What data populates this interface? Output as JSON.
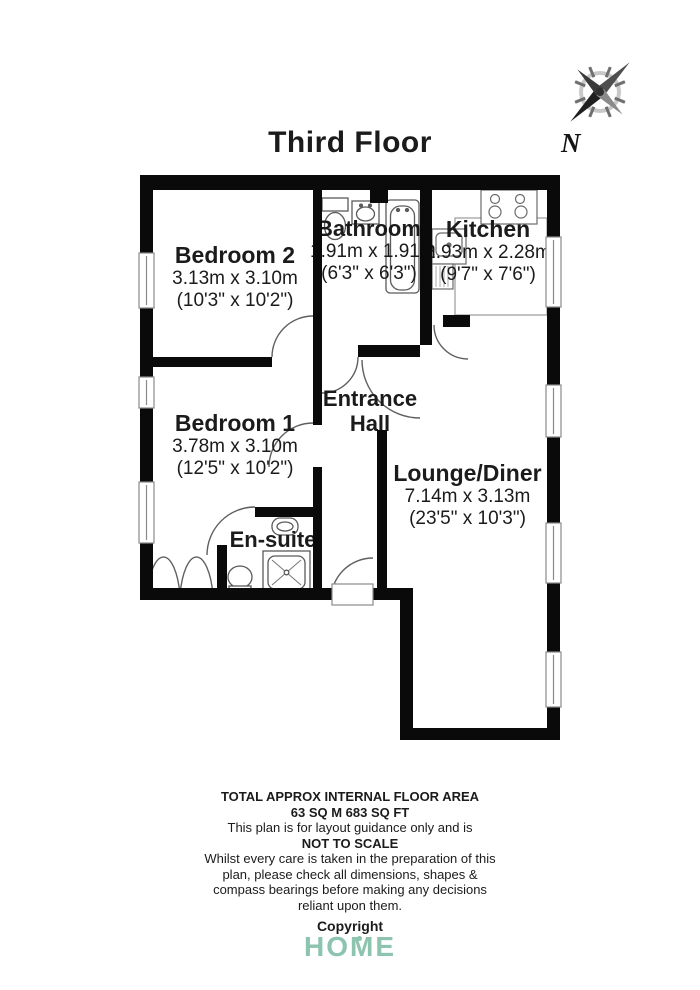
{
  "title": "Third Floor",
  "compass": {
    "label": "N"
  },
  "rooms": {
    "bedroom2": {
      "name": "Bedroom 2",
      "metric": "3.13m x 3.10m",
      "imperial": "(10'3\" x 10'2\")"
    },
    "bathroom": {
      "name": "Bathroom",
      "metric": "1.91m x 1.91m",
      "imperial": "(6'3\" x 6'3\")"
    },
    "kitchen": {
      "name": "Kitchen",
      "metric": "2.93m x 2.28m",
      "imperial": "(9'7\" x 7'6\")"
    },
    "bedroom1": {
      "name": "Bedroom 1",
      "metric": "3.78m x 3.10m",
      "imperial": "(12'5\" x 10'2\")"
    },
    "entrance_hall": {
      "name_line1": "Entrance",
      "name_line2": "Hall"
    },
    "ensuite": {
      "name": "En-suite"
    },
    "lounge": {
      "name": "Lounge/Diner",
      "metric": "7.14m x 3.13m",
      "imperial": "(23'5\" x 10'3\")"
    }
  },
  "footer": {
    "lines": [
      "TOTAL APPROX INTERNAL FLOOR AREA",
      "63 SQ M 683 SQ FT",
      "This plan is for layout guidance only and is",
      "NOT TO SCALE",
      "Whilst every care is taken in the preparation of this",
      "plan, please check all dimensions, shapes &",
      "compass bearings before making any decisions",
      "reliant upon them."
    ],
    "copyright": "Copyright",
    "logo": "HOME"
  },
  "colors": {
    "wall": "#0a0a0a",
    "logo_teal": "#8cc4b0",
    "text": "#1b1b1b"
  }
}
